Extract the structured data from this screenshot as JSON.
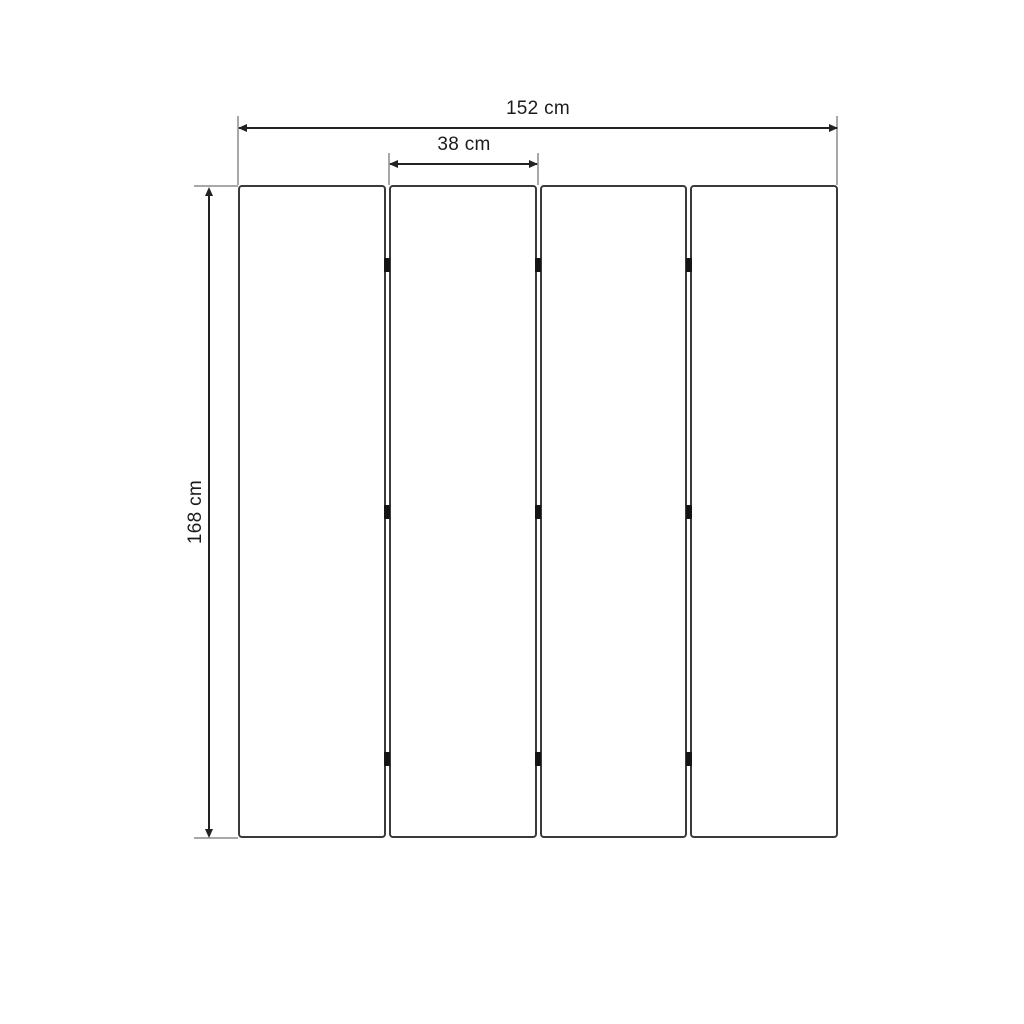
{
  "diagram": {
    "type": "product-dimension-diagram",
    "subject": "four-panel folding screen, front view",
    "labels": {
      "total_width": "152 cm",
      "panel_width": "38 cm",
      "height": "168 cm"
    },
    "panel_count": 4,
    "hinge_rows": 3,
    "hinge_columns": 3,
    "colors": {
      "background": "#ffffff",
      "panel_border": "#3a3a3a",
      "dimension_line": "#222222",
      "extension_line": "#a8a8a8",
      "hinge": "#141414",
      "text": "#1c1c1c"
    }
  }
}
